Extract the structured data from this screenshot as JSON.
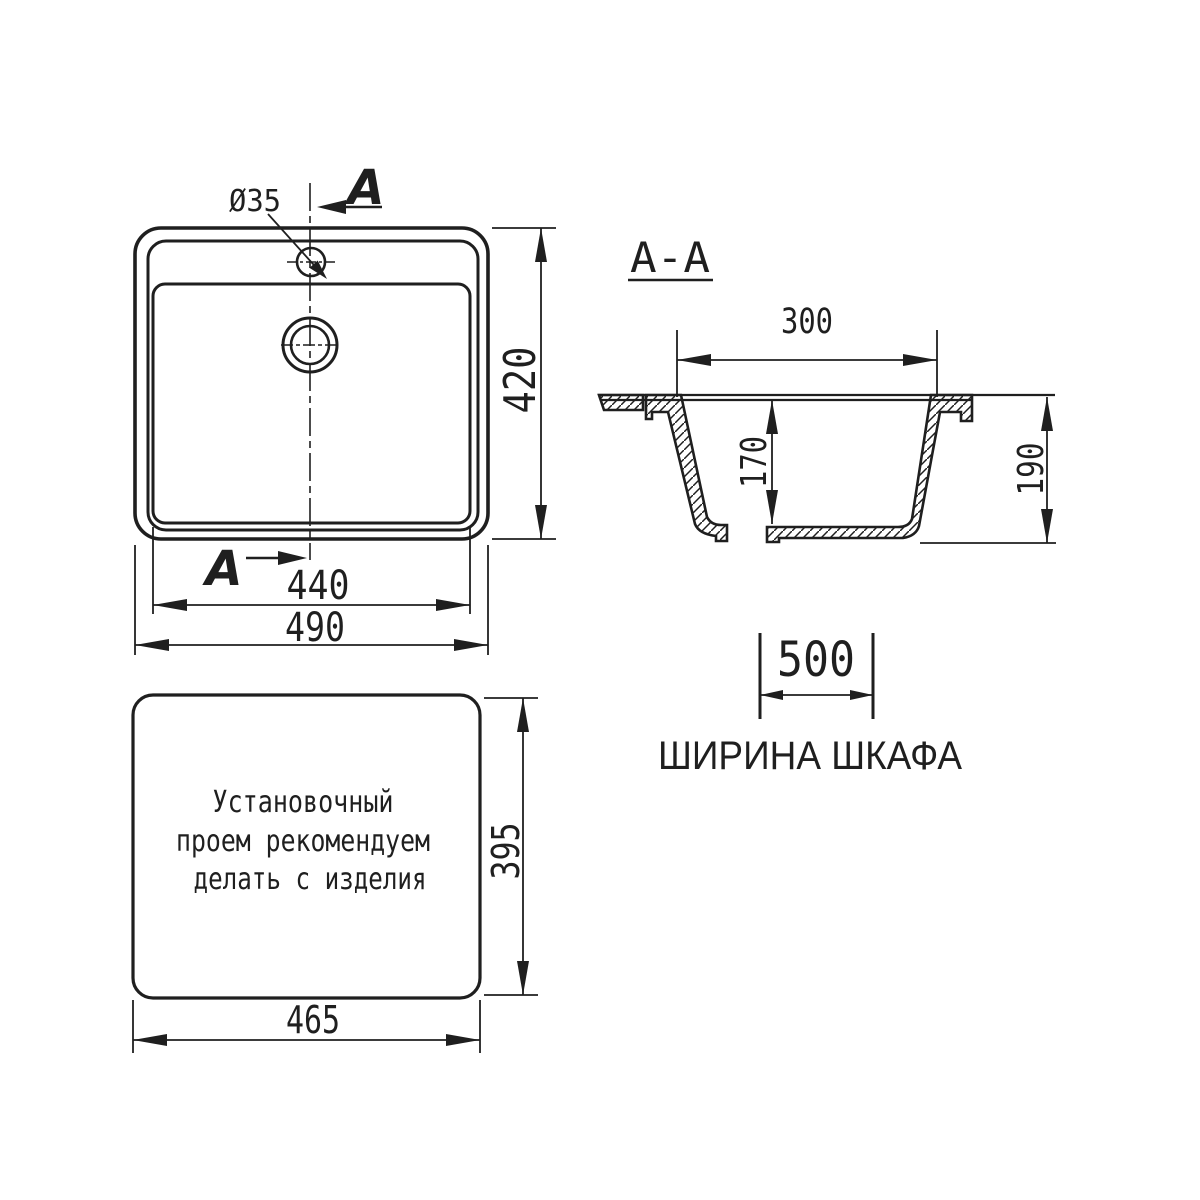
{
  "colors": {
    "line": "#1f1f1f",
    "background": "#ffffff"
  },
  "top_view": {
    "hole_label": "Ø35",
    "section_arrow_top": "A",
    "section_arrow_bottom": "A",
    "dim_inner_width": "440",
    "dim_outer_width": "490",
    "dim_depth": "420"
  },
  "section_view": {
    "title": "A-A",
    "dim_top_width": "300",
    "dim_bowl_depth": "170",
    "dim_total_height": "190"
  },
  "cabinet_note": {
    "dim_width": "500",
    "label": "ШИРИНА ШКАФА"
  },
  "cutout_view": {
    "note_lines": [
      "Установочный",
      "проем рекомендуем",
      "делать с изделия"
    ],
    "dim_width": "465",
    "dim_height": "395"
  }
}
